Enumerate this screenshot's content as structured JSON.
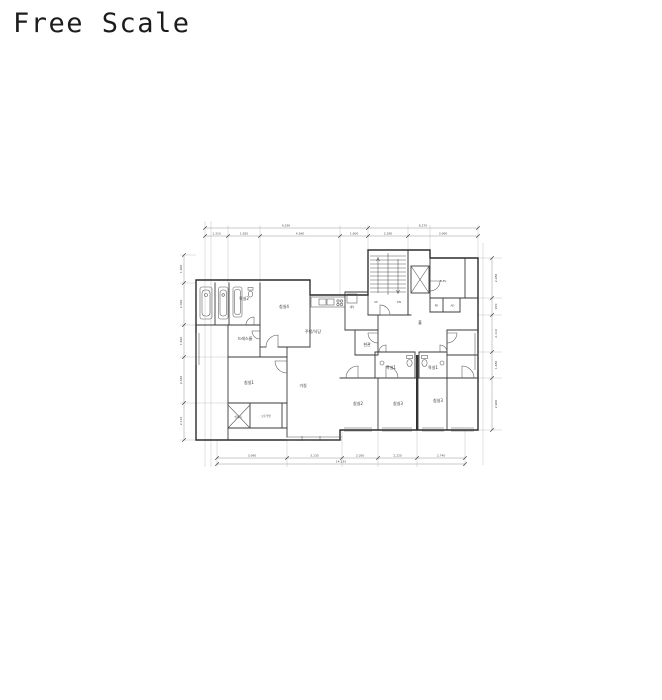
{
  "page": {
    "title": "Free Scale",
    "background": "#ffffff"
  },
  "plan": {
    "colors": {
      "wall": "#2b2b2b",
      "fixture": "#555555",
      "dimension": "#8a8a8a",
      "label": "#333333",
      "party_wall": "#333333"
    },
    "rooms": [
      {
        "label": "욕실2"
      },
      {
        "label": "침실4"
      },
      {
        "label": "드레스룸"
      },
      {
        "label": "침실1"
      },
      {
        "label": "거실"
      },
      {
        "label": "주방/식당"
      },
      {
        "label": "현관"
      },
      {
        "label": "욕실1"
      },
      {
        "label": "욕실1"
      },
      {
        "label": "침실2"
      },
      {
        "label": "침실3"
      },
      {
        "label": "침실3"
      },
      {
        "label": "홀"
      },
      {
        "label": "ELEV"
      },
      {
        "label": "실외기"
      },
      {
        "label": "보조주방"
      },
      {
        "label": "세탁"
      },
      {
        "label": "PD"
      },
      {
        "label": "AD"
      }
    ],
    "stairs": {
      "up": "UP",
      "down": "DN"
    },
    "dims": {
      "top_row1": [
        "9,290",
        "6,270"
      ],
      "top_row2": [
        "1,310",
        "1,820",
        "4,560",
        "1,600",
        "2,280",
        "3,990"
      ],
      "bottom": [
        "3,990",
        "3,135",
        "2,050",
        "2,220",
        "2,740"
      ],
      "bottom_overall": "14,135",
      "left": [
        "1,600",
        "2,390",
        "1,820",
        "2,620",
        "2,110"
      ],
      "right": [
        "2,280",
        "970",
        "2,110",
        "1,480",
        "2,960"
      ]
    }
  }
}
